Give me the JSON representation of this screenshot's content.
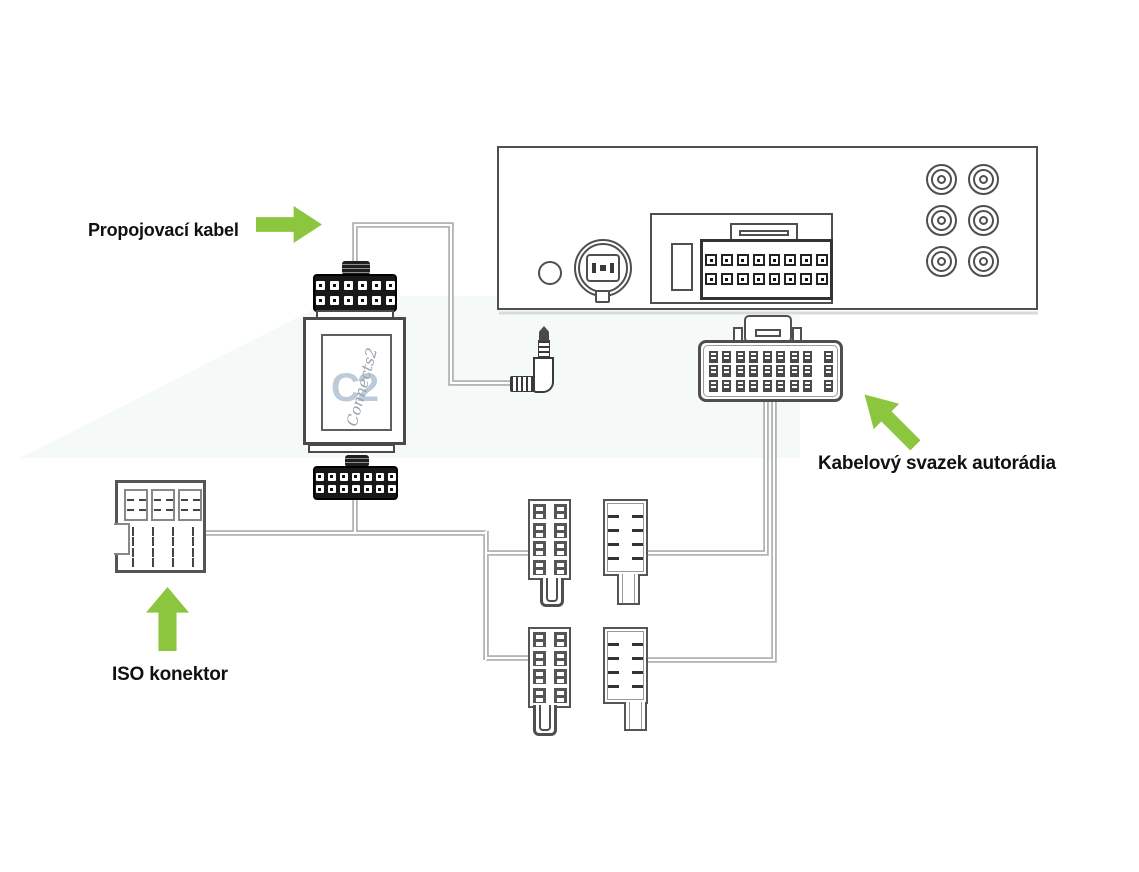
{
  "diagram": {
    "title": "car-stereo-adapter-wiring-diagram",
    "colors": {
      "accent_green": "#8CC63E",
      "outline": "#4f4f4f",
      "wire": "#a9adad",
      "background_tint": "#f3f7f6"
    },
    "labels": {
      "connecting_cable": "Propojovací kabel",
      "radio_harness": "Kabelový svazek autorádia",
      "iso_connector": "ISO konektor"
    },
    "adapter": {
      "logo_monogram": "C2",
      "logo_script": "Connects2"
    },
    "connectors": {
      "adapter_top_plug": {
        "rows": 2,
        "cols": 6
      },
      "adapter_bottom_plug": {
        "rows": 2,
        "cols": 7
      },
      "radio_socket_pins": {
        "rows": 2,
        "cols": 8
      },
      "harness_terminals": {
        "rows": 3,
        "cols": 9
      },
      "rca_jacks": {
        "rows": 3,
        "cols": 2
      },
      "terminal_plug_upper": {
        "rows": 4,
        "cols": 2
      },
      "terminal_plug_lower": {
        "rows": 4,
        "cols": 2
      },
      "keyed_plug_upper": {
        "rows": 4,
        "cols": 2
      },
      "keyed_plug_lower": {
        "rows": 4,
        "cols": 2
      },
      "iso_block": {
        "rows": 2,
        "cols": 2
      },
      "iso_pin_field": {
        "rows": 4,
        "cols": 4
      }
    }
  }
}
